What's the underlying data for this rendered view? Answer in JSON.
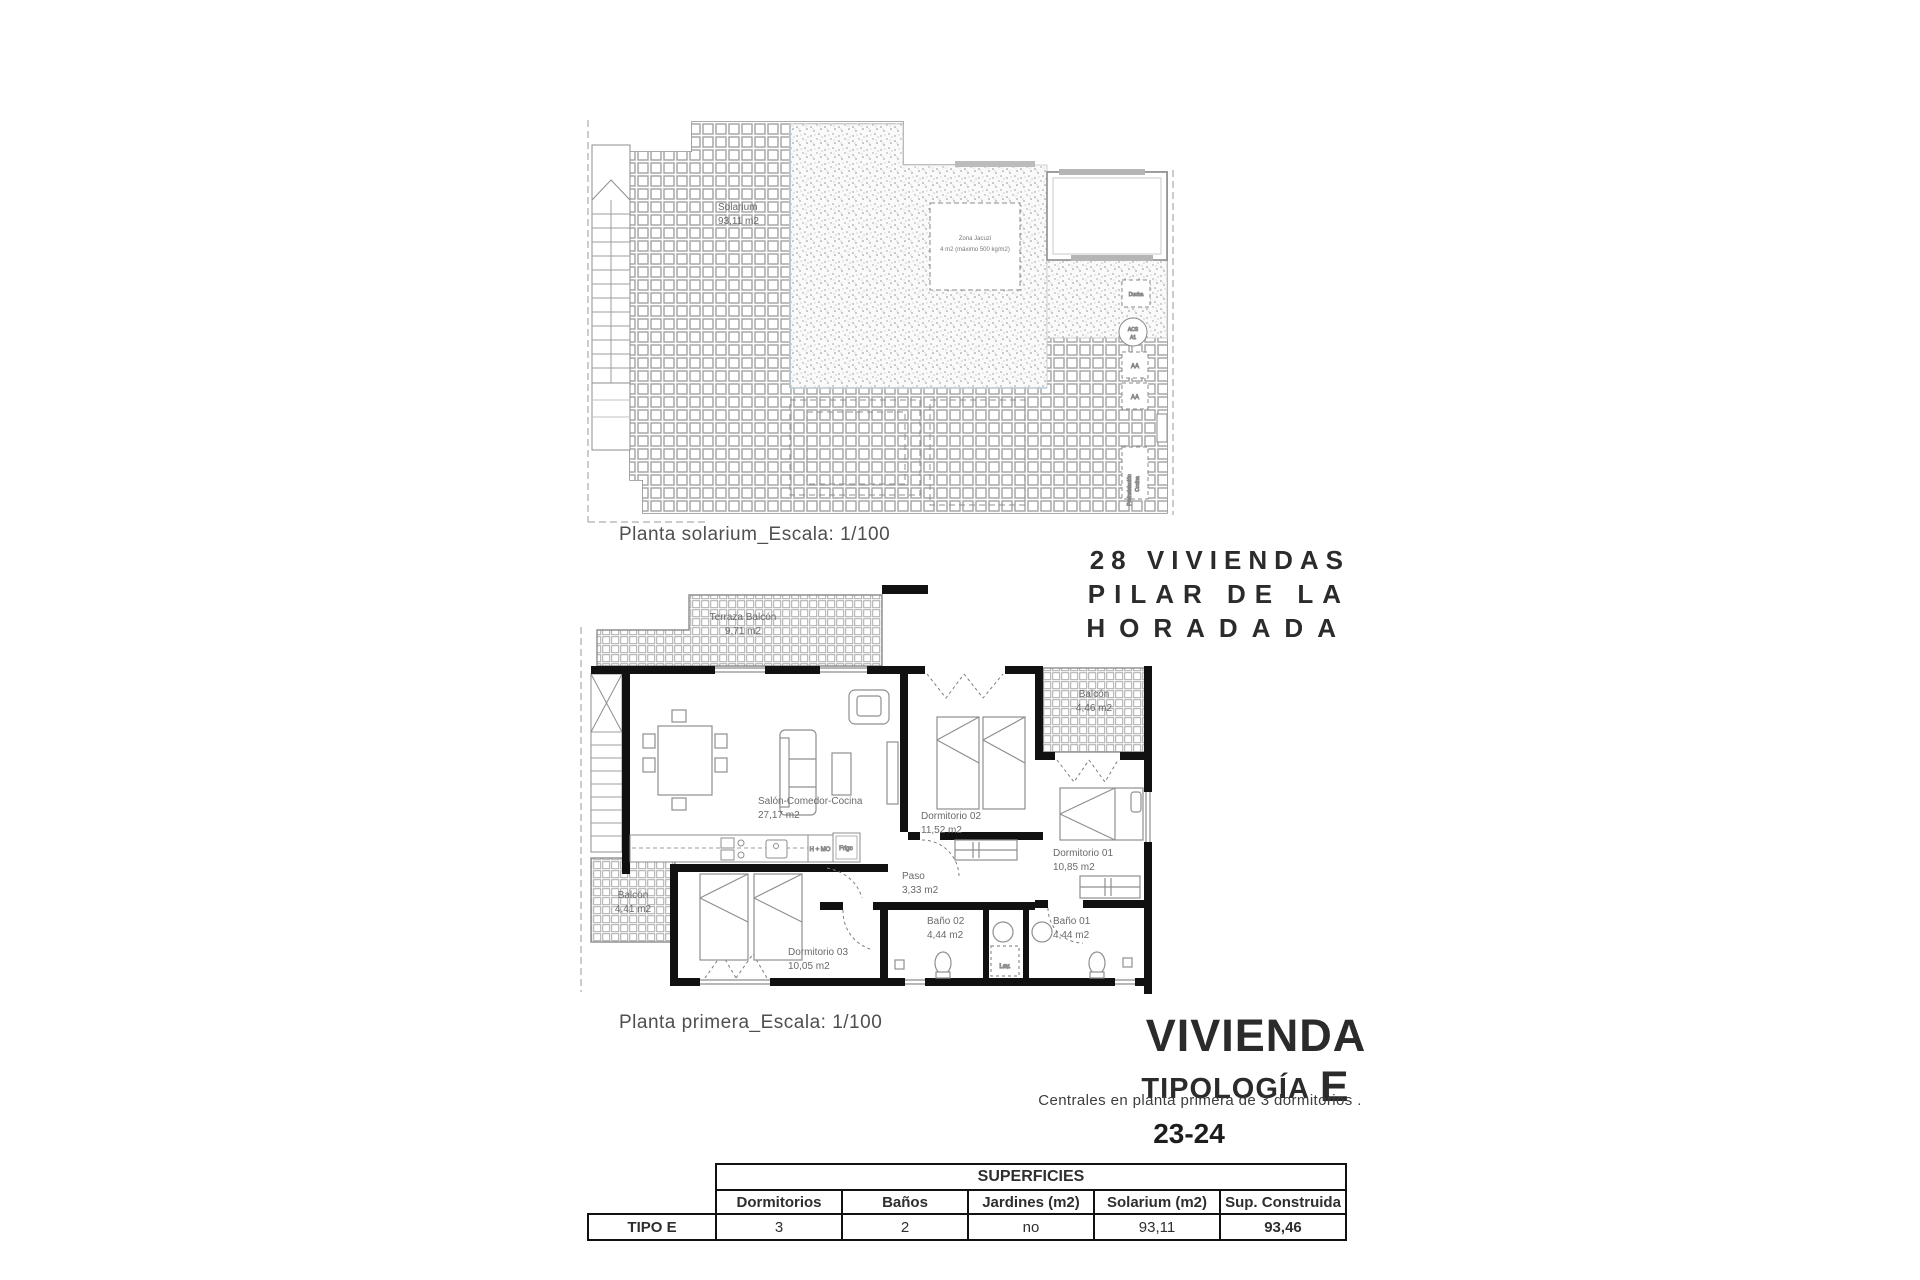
{
  "solarium_plan": {
    "caption": "Planta solarium_Escala: 1/100",
    "room_label": "Solarium",
    "room_area": "93,11 m2",
    "jacuzzi_label": "Zona Jacuzi",
    "jacuzzi_note": "4 m2 (máximo 500 kg/m2)",
    "ducha": "Ducha",
    "acs": "ACS",
    "a1": "A1",
    "aa_top": "AA",
    "aa_bottom": "AA",
    "preinstalacion": "Preinstalación",
    "cocina": "Cocina"
  },
  "first_floor_plan": {
    "caption": "Planta primera_Escala: 1/100",
    "terraza_label": "Terraza Balcón",
    "terraza_area": "9,71 m2",
    "salon_label": "Salón-Comedor-Cocina",
    "salon_area": "27,17 m2",
    "dorm2_label": "Dormitorio 02",
    "dorm2_area": "11,52 m2",
    "balcon_right_label": "Balcón",
    "balcon_right_area": "4,46 m2",
    "dorm1_label": "Dormitorio 01",
    "dorm1_area": "10,85 m2",
    "paso_label": "Paso",
    "paso_area": "3,33 m2",
    "bano2_label": "Baño 02",
    "bano2_area": "4,44 m2",
    "bano1_label": "Baño 01",
    "bano1_area": "4,44 m2",
    "dorm3_label": "Dormitorio 03",
    "dorm3_area": "10,05 m2",
    "balcon_left_label": "Balcón",
    "balcon_left_area": "4,41 m2",
    "kitchen_hmo": "H + MO",
    "kitchen_frigo": "Frigo",
    "lav": "Lav."
  },
  "project": {
    "line1": "28 VIVIENDAS",
    "line2": "PILAR DE LA",
    "line3": "HORADADA"
  },
  "typology": {
    "title": "VIVIENDA",
    "subtitle": "TIPOLOGÍA",
    "letter": "E",
    "description": "Centrales en planta primera de 3 dormitorios .",
    "units": "23-24"
  },
  "table": {
    "row_header": "TIPO E",
    "group_header": "SUPERFICIES",
    "columns": [
      "Dormitorios",
      "Baños",
      "Jardines (m2)",
      "Solarium (m2)",
      "Sup. Construida"
    ],
    "values": [
      "3",
      "2",
      "no",
      "93,11",
      "93,46"
    ]
  }
}
